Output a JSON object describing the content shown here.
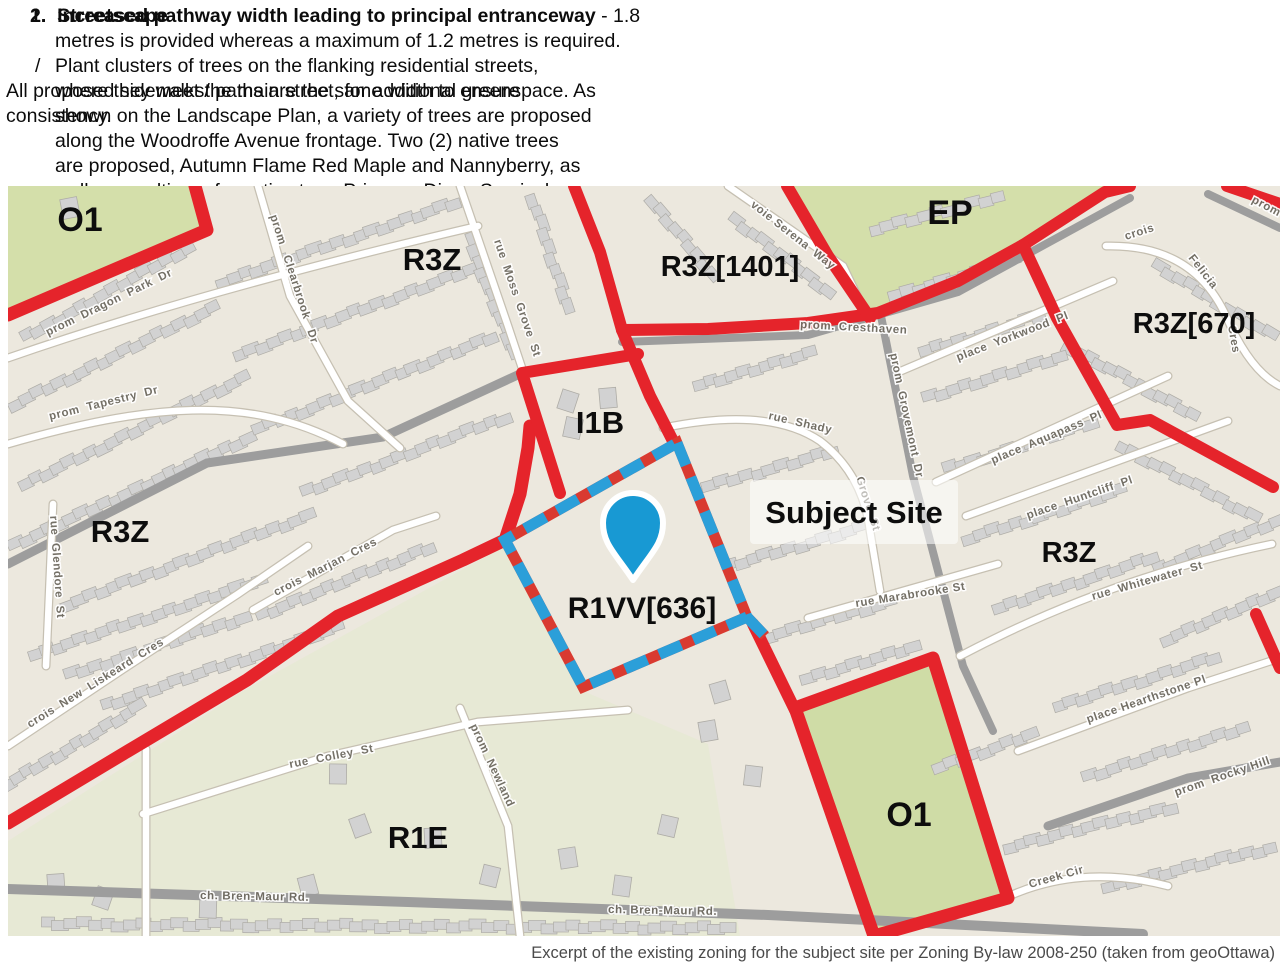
{
  "text_block": {
    "item": {
      "num2": "2.",
      "title2": "Streetscape",
      "num1": "1.",
      "line1_bold": "Increased pathway width leading to principal entranceway",
      "line1_tail": " - 1.8",
      "line2": "metres is provided whereas a maximum of 1.2 metres is required."
    },
    "bullet": {
      "marker": "/",
      "lines": [
        "Plant clusters of trees on the flanking residential streets,",
        "where they meet the main street, for additional greenspace. As",
        "shown on the Landscape Plan, a variety of trees are proposed",
        "along the Woodroffe Avenue frontage. Two (2) native trees",
        "are proposed, Autumn Flame Red Maple and Nannyberry, as",
        "well as a cultivar of a native tree, Princess Diana Serviceberry"
      ]
    },
    "overlay": {
      "lines": [
        "All proposed sidewalks/ paths are the same width to ensure",
        "consistency."
      ]
    }
  },
  "map": {
    "colors": {
      "background": "#ece8de",
      "zone_green": "#d4dfaa",
      "boundary_red": "#e5242b",
      "dash_blue": "#2b9fd9",
      "building_fill": "#d2d2d2",
      "road_gray": "#9d9d9d",
      "street_white": "#ffffff",
      "pin_blue": "#1899d3"
    },
    "subject_site": {
      "label": "Subject Site",
      "x": 846,
      "y": 327
    },
    "zone_labels": [
      {
        "text": "O1",
        "x": 72,
        "y": 45,
        "s": 34
      },
      {
        "text": "R3Z",
        "x": 424,
        "y": 84,
        "s": 31
      },
      {
        "text": "R3Z[1401]",
        "x": 722,
        "y": 90,
        "s": 29
      },
      {
        "text": "EP",
        "x": 942,
        "y": 38,
        "s": 34
      },
      {
        "text": "R3Z[670]",
        "x": 1186,
        "y": 147,
        "s": 29
      },
      {
        "text": "I1B",
        "x": 592,
        "y": 247,
        "s": 31
      },
      {
        "text": "R1VV[636]",
        "x": 634,
        "y": 432,
        "s": 30
      },
      {
        "text": "R3Z",
        "x": 112,
        "y": 356,
        "s": 31
      },
      {
        "text": "R3Z",
        "x": 1061,
        "y": 376,
        "s": 29
      },
      {
        "text": "R1E",
        "x": 410,
        "y": 662,
        "s": 31
      },
      {
        "text": "O1",
        "x": 901,
        "y": 640,
        "s": 34
      }
    ],
    "street_labels": [
      {
        "text": "prom  Dragon  Park  Dr",
        "x": 40,
        "y": 150,
        "r": -26
      },
      {
        "text": "prom   Clearbrook   Dr",
        "x": 262,
        "y": 30,
        "r": 72
      },
      {
        "text": "prom  Tapestry  Dr",
        "x": 42,
        "y": 234,
        "r": -14
      },
      {
        "text": "rue  Moss  Grove  St",
        "x": 486,
        "y": 55,
        "r": 71
      },
      {
        "text": "voie Serena  Way",
        "x": 742,
        "y": 20,
        "r": 38
      },
      {
        "text": "rue  Shady",
        "x": 760,
        "y": 233,
        "r": 13
      },
      {
        "text": "Grove  St",
        "x": 848,
        "y": 292,
        "r": 72
      },
      {
        "text": "place  Yorkwood  Pl",
        "x": 950,
        "y": 175,
        "r": -21
      },
      {
        "text": "place  Aquapass  Pl",
        "x": 985,
        "y": 278,
        "r": -23
      },
      {
        "text": "place  Huntcliff  Pl",
        "x": 1020,
        "y": 333,
        "r": -19
      },
      {
        "text": "rue  Whitewater  St",
        "x": 1085,
        "y": 414,
        "r": -16
      },
      {
        "text": "rue Marabrooke St",
        "x": 848,
        "y": 421,
        "r": -9
      },
      {
        "text": "crois",
        "x": 1118,
        "y": 54,
        "r": -18
      },
      {
        "text": "Felicia",
        "x": 1180,
        "y": 72,
        "r": 52
      },
      {
        "text": "Cres",
        "x": 1220,
        "y": 140,
        "r": 80
      },
      {
        "text": "prom  Grovemont  Dr",
        "x": 882,
        "y": 168,
        "r": 78
      },
      {
        "text": "crois  Marjan  Cres",
        "x": 268,
        "y": 410,
        "r": -27
      },
      {
        "text": "rue  Glendore  St",
        "x": 42,
        "y": 330,
        "r": 86
      },
      {
        "text": "crois  New  Liskeard  Cres",
        "x": 22,
        "y": 542,
        "r": -32
      },
      {
        "text": "rue  Colley  St",
        "x": 282,
        "y": 582,
        "r": -11
      },
      {
        "text": "prom  Newland",
        "x": 462,
        "y": 540,
        "r": 65
      },
      {
        "text": "ch. Bren-Maur Rd.",
        "x": 192,
        "y": 713,
        "r": 1
      },
      {
        "text": "ch. Bren-Maur Rd.",
        "x": 600,
        "y": 727,
        "r": 1
      },
      {
        "text": "place Hearthstone Pl",
        "x": 1080,
        "y": 537,
        "r": -19
      },
      {
        "text": "prom  Rocky Hill",
        "x": 1168,
        "y": 610,
        "r": -19
      },
      {
        "text": "Creek Cir",
        "x": 1022,
        "y": 702,
        "r": -16
      },
      {
        "text": "prom. Cresthaven",
        "x": 792,
        "y": 142,
        "r": 3
      },
      {
        "text": "prom",
        "x": 1243,
        "y": 16,
        "r": 28
      }
    ]
  },
  "caption": "Excerpt of the existing zoning for the subject site per Zoning By-law 2008-250 (taken from geoOttawa)"
}
